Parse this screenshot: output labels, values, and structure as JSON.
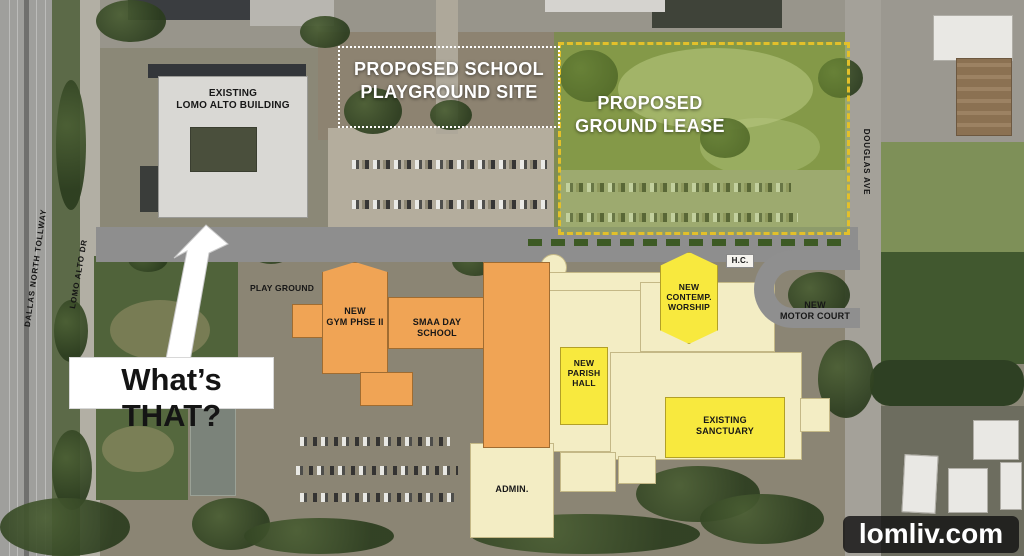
{
  "annotation": {
    "text": "What’s THAT?"
  },
  "watermark": {
    "text": "lomliv.com"
  },
  "roads": {
    "dallas_north_tollway": "DALLAS NORTH TOLLWAY",
    "lomo_alto_dr": "LOMO ALTO DR",
    "douglas_ave": "DOUGLAS AVE"
  },
  "overlays": {
    "playground_site": "PROPOSED SCHOOL\nPLAYGROUND SITE",
    "ground_lease": "PROPOSED\nGROUND LEASE"
  },
  "buildings": {
    "existing_lomo_alto": "EXISTING\nLOMO ALTO BUILDING",
    "new_gym": "NEW\nGYM PHSE II",
    "smaa_day_school": "SMAA DAY SCHOOL",
    "new_contemp_worship": "NEW\nCONTEMP.\nWORSHIP",
    "new_parish_hall": "NEW\nPARISH\nHALL",
    "existing_sanctuary": "EXISTING\nSANCTUARY",
    "admin": "ADMIN.",
    "hc": "H.C."
  },
  "site_labels": {
    "play_ground": "PLAY GROUND",
    "new_motor_court": "NEW\nMOTOR COURT"
  },
  "colors": {
    "new_building_orange": "#f0a455",
    "proposed_yellow": "#f8e93e",
    "existing_cream": "#f3edc4",
    "existing_gray": "#d9d8d4",
    "lease_outline": "#e3c02a",
    "lease_tint": "rgba(140,175,60,0.42)",
    "road_gray": "#8e8e8e"
  }
}
